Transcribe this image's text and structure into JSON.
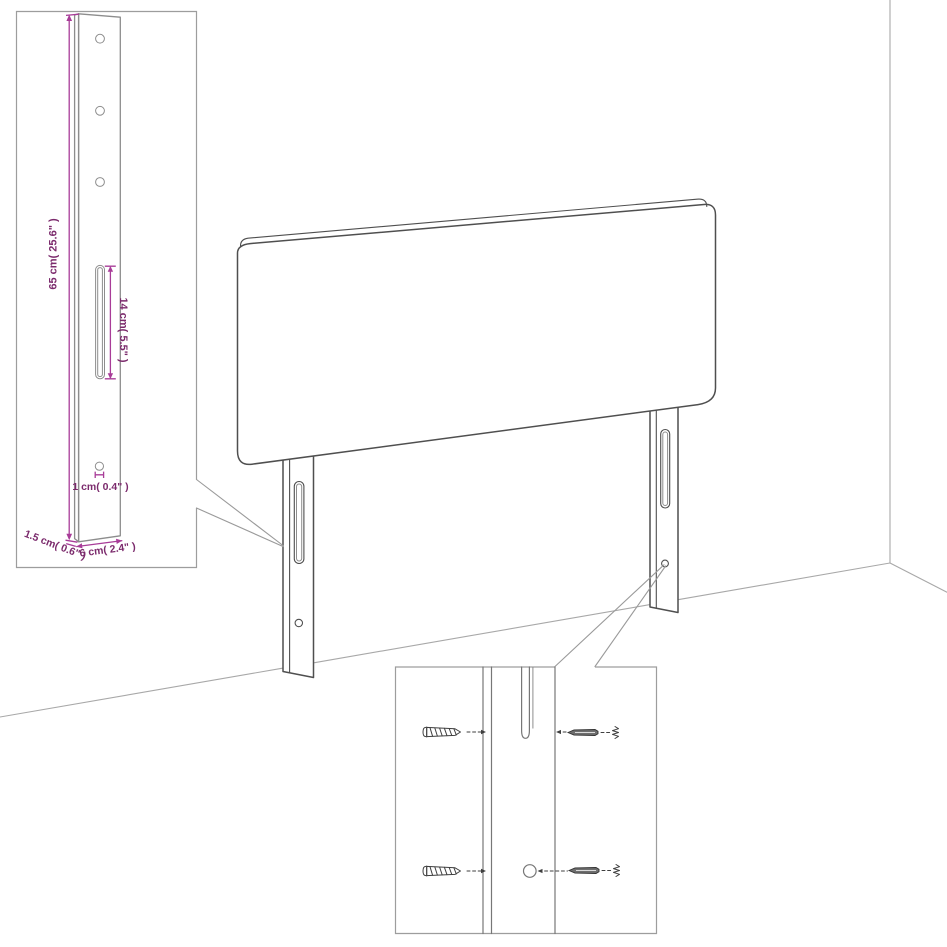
{
  "diagram": {
    "colors": {
      "dimension_line": "#a83c98",
      "dimension_text": "#7b2a6c",
      "product_outline": "#4f4f4f",
      "inset_border": "#9d9d9d",
      "background": "#ffffff"
    },
    "leg_detail_inset": {
      "height_label": "65 cm( 25.6\" )",
      "slot_label": "14 cm( 5.5\" )",
      "hole_label": "1 cm( 0.4\" )",
      "side_thickness_label": "1.5 cm( 0.6\" )",
      "width_label": "6 cm( 2.4\" )"
    },
    "hardware_inset": {
      "items": [
        "screw-icon",
        "screw-icon",
        "wall-plug-icon",
        "wall-plug-icon"
      ]
    }
  }
}
